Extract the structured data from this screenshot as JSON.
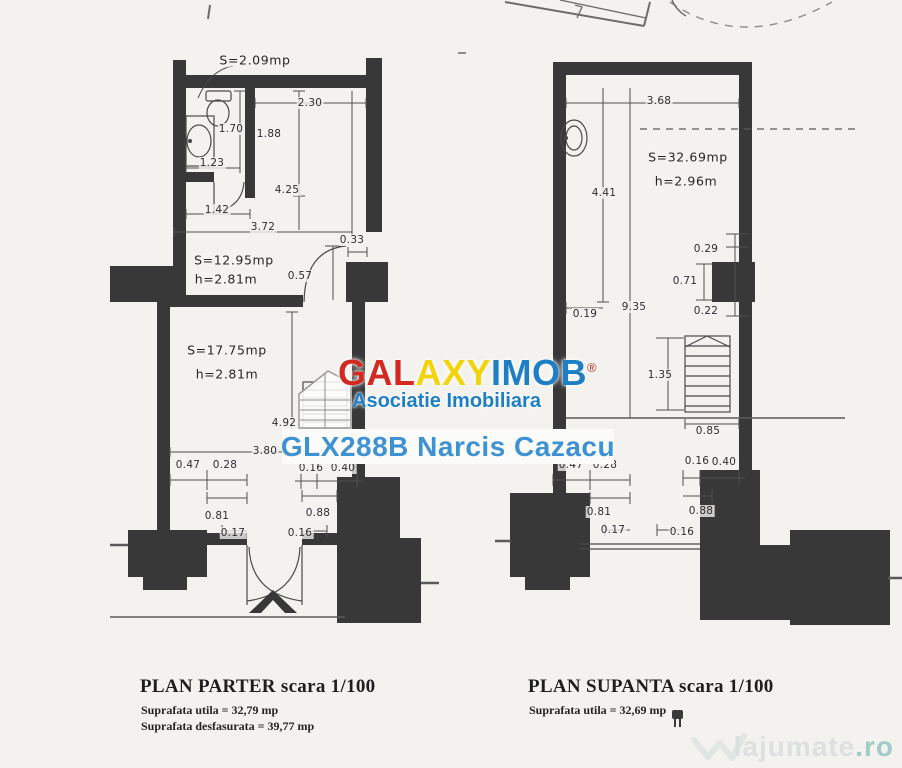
{
  "page": {
    "background": "#f3f2ef",
    "ink": "#383838"
  },
  "watermark": {
    "brand_segments": [
      {
        "text": "GAL",
        "color": "#d22a20"
      },
      {
        "text": "AXY",
        "color": "#f2d40e"
      },
      {
        "text": "IMOB",
        "color": "#1e7fc4"
      }
    ],
    "registered_mark": "®",
    "subtitle": "Asociatie Imobiliara",
    "subtitle_color": "#1e7fc4",
    "listing_line": "GLX288B Narcis Cazacu",
    "listing_color": "#3e92d2"
  },
  "site_logo": {
    "name": "lajumate",
    "tld": ".ro",
    "color": "#dce1e0",
    "tld_color": "#a3cbc6"
  },
  "plans": [
    {
      "id": "parter",
      "title": "PLAN PARTER",
      "scale_note": "scara 1/100",
      "footer_lines": [
        "Suprafata utila = 32,79 mp",
        "Suprafata desfasurata = 39,77 mp"
      ],
      "room_labels": [
        {
          "text": "S=2.09mp",
          "x": 255,
          "y": 60
        },
        {
          "text": "S=12.95mp",
          "x": 234,
          "y": 260
        },
        {
          "text": "h=2.81m",
          "x": 226,
          "y": 279
        },
        {
          "text": "S=17.75mp",
          "x": 227,
          "y": 350
        },
        {
          "text": "h=2.81m",
          "x": 227,
          "y": 374
        }
      ],
      "dimensions": [
        {
          "text": "2.30",
          "x": 310,
          "y": 103
        },
        {
          "text": "1.70",
          "x": 231,
          "y": 129
        },
        {
          "text": "1.88",
          "x": 269,
          "y": 134
        },
        {
          "text": "1.23",
          "x": 212,
          "y": 163
        },
        {
          "text": "4.25",
          "x": 287,
          "y": 190
        },
        {
          "text": "1.42",
          "x": 217,
          "y": 210
        },
        {
          "text": "3.72",
          "x": 263,
          "y": 227
        },
        {
          "text": "0.33",
          "x": 352,
          "y": 240
        },
        {
          "text": "0.57",
          "x": 300,
          "y": 276
        },
        {
          "text": "4.92",
          "x": 284,
          "y": 423
        },
        {
          "text": "3.80",
          "x": 265,
          "y": 451
        },
        {
          "text": "0.47",
          "x": 188,
          "y": 465
        },
        {
          "text": "0.28",
          "x": 225,
          "y": 465
        },
        {
          "text": "0.16",
          "x": 311,
          "y": 468
        },
        {
          "text": "0.40",
          "x": 343,
          "y": 468
        },
        {
          "text": "0.81",
          "x": 217,
          "y": 516
        },
        {
          "text": "0.88",
          "x": 318,
          "y": 513
        },
        {
          "text": "0.17",
          "x": 233,
          "y": 533
        },
        {
          "text": "0.16",
          "x": 300,
          "y": 533
        }
      ]
    },
    {
      "id": "supanta",
      "title": "PLAN SUPANTA",
      "scale_note": "scara 1/100",
      "footer_lines": [
        "Suprafata utila = 32,69 mp"
      ],
      "room_labels": [
        {
          "text": "S=32.69mp",
          "x": 688,
          "y": 157
        },
        {
          "text": "h=2.96m",
          "x": 686,
          "y": 181
        }
      ],
      "dimensions": [
        {
          "text": "3.68",
          "x": 659,
          "y": 101
        },
        {
          "text": "4.41",
          "x": 604,
          "y": 193
        },
        {
          "text": "0.29",
          "x": 706,
          "y": 249
        },
        {
          "text": "0.71",
          "x": 685,
          "y": 281
        },
        {
          "text": "0.22",
          "x": 706,
          "y": 311
        },
        {
          "text": "0.19",
          "x": 585,
          "y": 314
        },
        {
          "text": "9.35",
          "x": 634,
          "y": 307
        },
        {
          "text": "1.35",
          "x": 660,
          "y": 375
        },
        {
          "text": "0.85",
          "x": 708,
          "y": 431
        },
        {
          "text": "0.47",
          "x": 571,
          "y": 465
        },
        {
          "text": "0.28",
          "x": 605,
          "y": 465
        },
        {
          "text": "0.16",
          "x": 697,
          "y": 461
        },
        {
          "text": "0.40",
          "x": 724,
          "y": 462
        },
        {
          "text": "0.81",
          "x": 599,
          "y": 512
        },
        {
          "text": "0.88",
          "x": 701,
          "y": 511
        },
        {
          "text": "0.17",
          "x": 613,
          "y": 530
        },
        {
          "text": "0.16",
          "x": 682,
          "y": 532
        }
      ]
    }
  ]
}
